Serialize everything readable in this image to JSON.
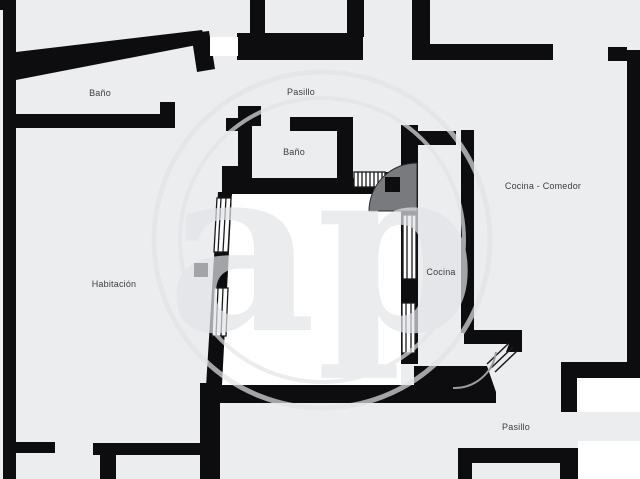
{
  "plan": {
    "title": "Apartment floor plan",
    "watermark_text": "ap",
    "rooms": [
      {
        "id": "bano-top-left",
        "label": "Baño"
      },
      {
        "id": "pasillo-top",
        "label": "Pasillo"
      },
      {
        "id": "bano-middle",
        "label": "Baño"
      },
      {
        "id": "cocina-comedor",
        "label": "Cocina - Comedor"
      },
      {
        "id": "habitacion",
        "label": "Habitación"
      },
      {
        "id": "cocina",
        "label": "Cocina"
      },
      {
        "id": "pasillo-bottom",
        "label": "Pasillo"
      }
    ],
    "colors": {
      "background": "#ebedee",
      "walls": "#0d0d0f",
      "bright_room_fill": "#ffffff",
      "watermark": "#e3e4e8",
      "label_text": "#3d3d3f",
      "door_swing_fill": "#797a7e"
    }
  }
}
